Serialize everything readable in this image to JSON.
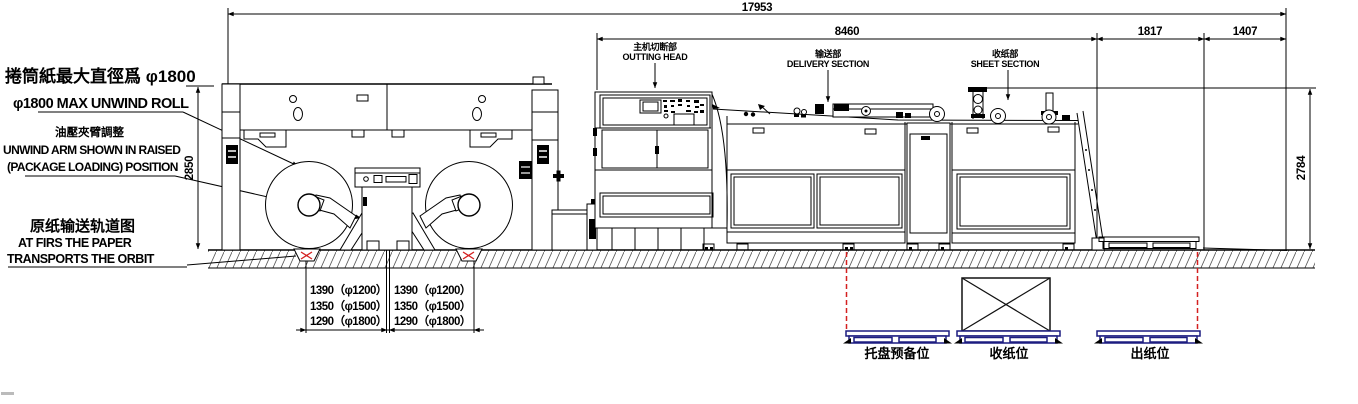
{
  "drawing": {
    "dims": {
      "total": "17953",
      "main": "8460",
      "d1817": "1817",
      "d1407": "1407",
      "h_left": "2850",
      "h_right": "2784"
    },
    "notes": {
      "roll": {
        "zh": "捲筒紙最大直徑爲 φ1800",
        "en": "φ1800 MAX UNWIND ROLL"
      },
      "arm": {
        "zh": "油壓夾臂調整",
        "en1": "UNWIND ARM SHOWN IN RAISED",
        "en2": "(PACKAGE LOADING) POSITION"
      },
      "track": {
        "zh": "原纸输送轨道图",
        "en1": "AT FIRS THE PAPER",
        "en2": "TRANSPORTS THE ORBIT"
      }
    },
    "sections": {
      "cutting": {
        "zh": "主机切断部",
        "en": "OUTTING HEAD"
      },
      "delivery": {
        "zh": "输送部",
        "en": "DELIVERY SECTION"
      },
      "sheet": {
        "zh": "收纸部",
        "en": "SHEET SECTION"
      }
    },
    "tables": {
      "left": [
        "1390（φ1200）",
        "1350（φ1500）",
        "1290（φ1800）"
      ],
      "right": [
        "1390（φ1200）",
        "1350（φ1500）",
        "1290（φ1800）"
      ]
    },
    "stations": {
      "ready": "托盘预备位",
      "collect": "收纸位",
      "out": "出纸位"
    },
    "colors": {
      "ink": "#000000",
      "pallet": "#1c1c80",
      "alert": "#d42020",
      "paper": "#ffffff"
    }
  }
}
